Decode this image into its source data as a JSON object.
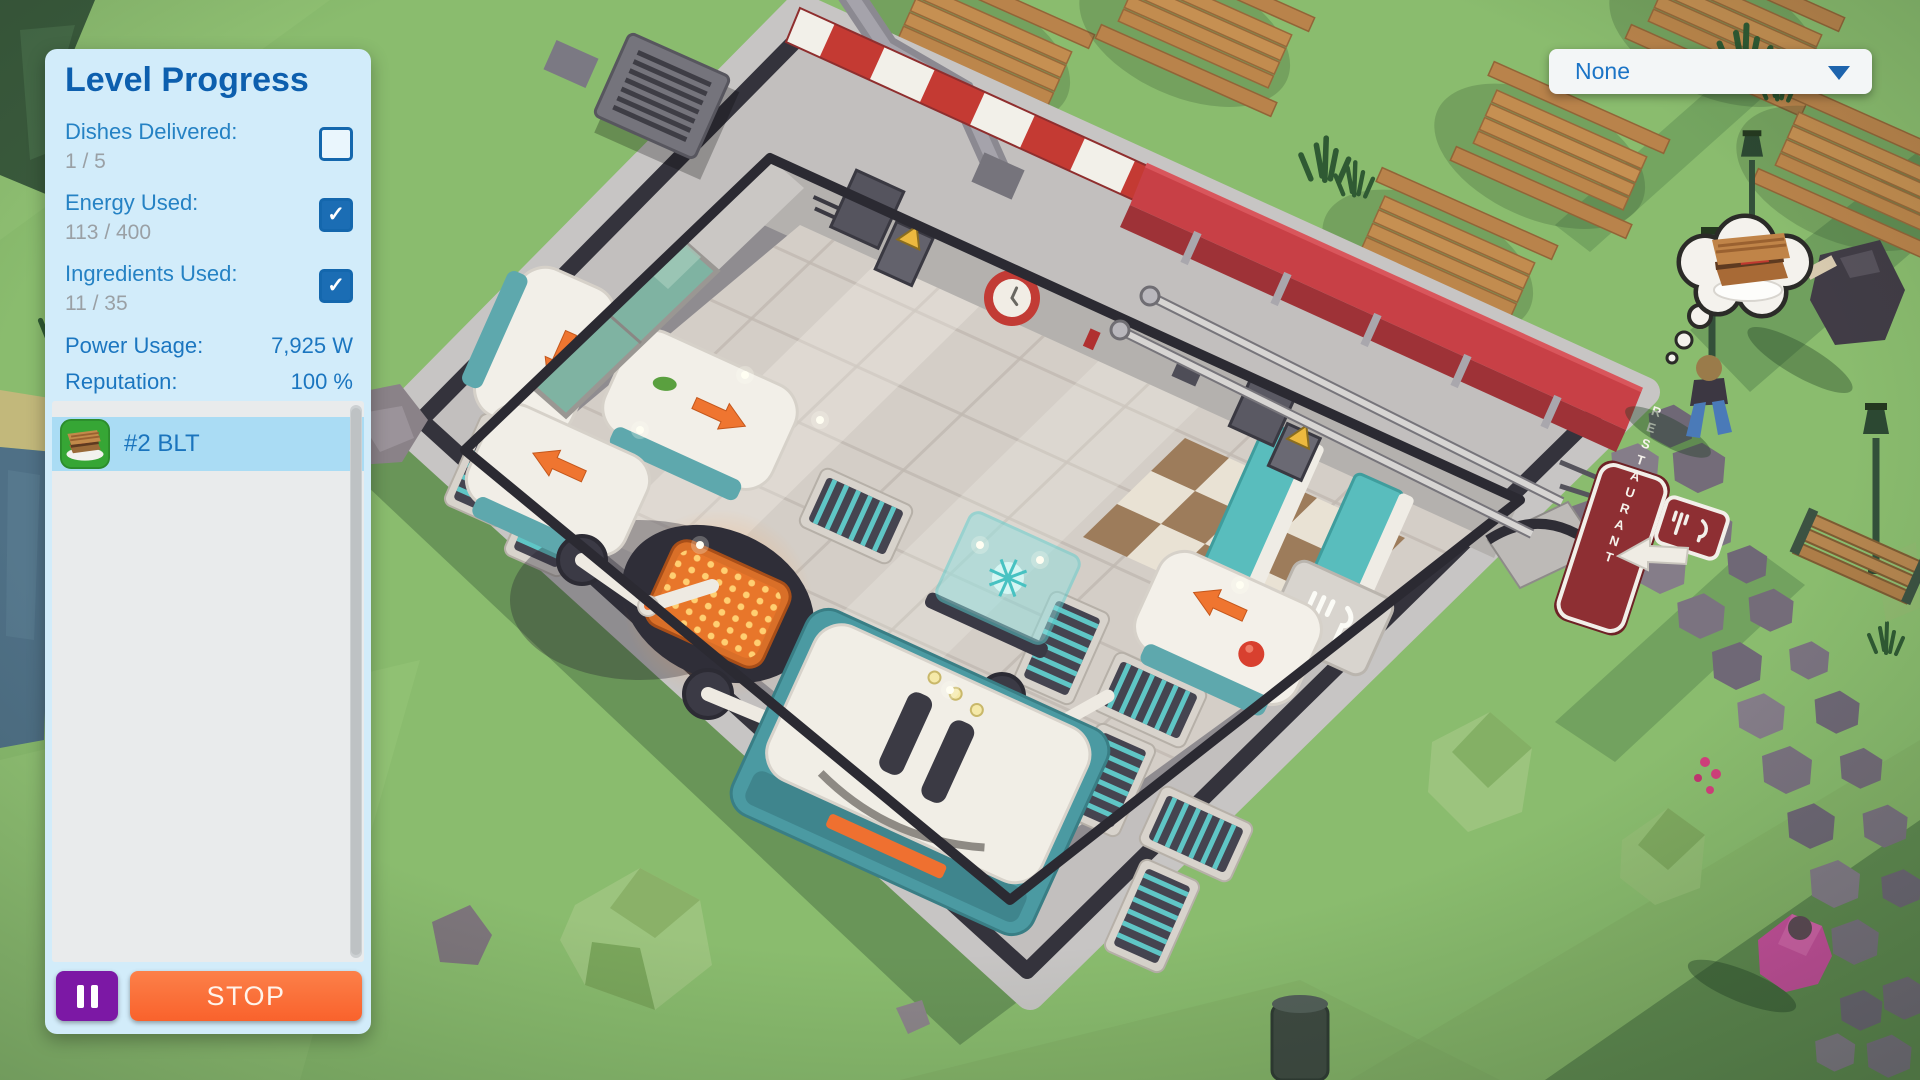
{
  "hud": {
    "level_panel": {
      "title": "Level Progress",
      "stats": [
        {
          "label": "Dishes Delivered:",
          "value": "1 / 5",
          "checked": false
        },
        {
          "label": "Energy Used:",
          "value": "113 / 400",
          "checked": true
        },
        {
          "label": "Ingredients Used:",
          "value": "11 / 35",
          "checked": true
        }
      ],
      "meters": [
        {
          "label": "Power Usage:",
          "value": "7,925 W"
        },
        {
          "label": "Reputation:",
          "value": "100 %"
        }
      ],
      "orders": [
        {
          "label": "#2 BLT",
          "selected": true,
          "icon": "blt-sandwich-icon"
        }
      ],
      "controls": {
        "stop_label": "STOP",
        "pause_icon": "pause-icon"
      }
    },
    "camera_dropdown": {
      "value": "None",
      "icon": "chevron-down-icon"
    },
    "icons": {
      "check": "✓"
    },
    "colors": {
      "accent_blue": "#1b74c6",
      "title_blue": "#0d5fae",
      "value_gray": "#9aa0a5",
      "panel_bg": "#d2ecfa",
      "list_bg": "#e9ebec",
      "selected_row": "#aadcf4",
      "stop_orange": "#f9622c",
      "pause_purple": "#7c18a5",
      "checkbox_blue": "#1467ad",
      "order_icon_green": "#36a635"
    }
  },
  "scene": {
    "restaurant_sign": {
      "text": "RESTAURANT",
      "icon": "fork-knife-sign-icon"
    },
    "serving_tile_icon": "fork-knife-icon",
    "thought_bubble": {
      "icon": "sandwich-icon"
    },
    "awning_colors": [
      "#c43a33",
      "#f2f0e9"
    ],
    "booth_red": "#c84046",
    "grass_green": "#8abc6e",
    "conveyor_teal": "#5fc6c6",
    "grill_glow_orange": "#ff9a40"
  }
}
